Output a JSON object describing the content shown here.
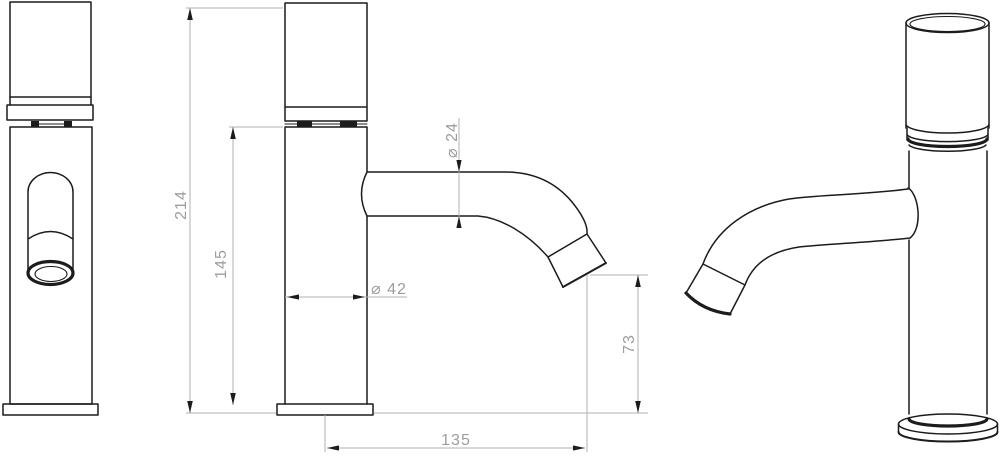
{
  "drawing": {
    "kind": "faucet-technical-drawing",
    "units": "mm",
    "views": [
      "front",
      "side-dimensioned",
      "perspective"
    ],
    "dimensions": {
      "total_height": "214",
      "body_height": "145",
      "body_diameter": "⌀ 42",
      "spout_diameter": "⌀ 24",
      "outlet_height": "73",
      "spout_reach": "135"
    },
    "colors": {
      "outline": "#1c1c1c",
      "dimension_line": "#b0b0b0",
      "dimension_text": "#9d9d9d",
      "background": "#ffffff"
    }
  }
}
